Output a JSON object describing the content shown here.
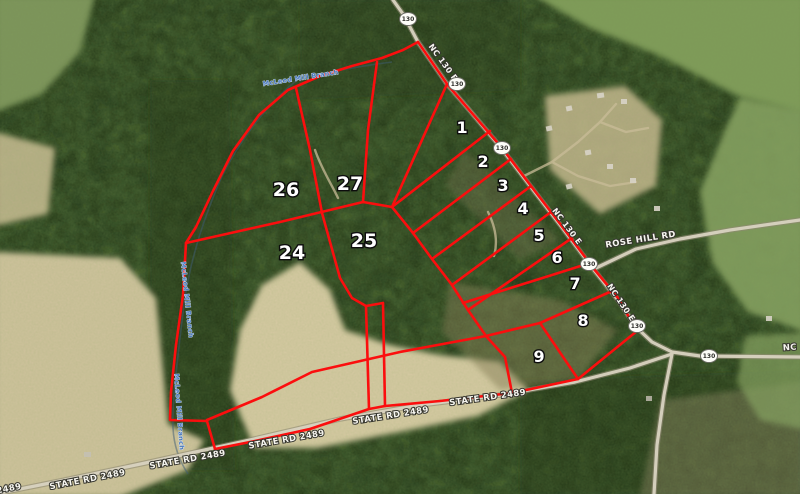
{
  "map": {
    "type": "aerial-parcel-map",
    "colors": {
      "parcel_line": "#fb0e0e",
      "lot_label_fill": "#ffffff",
      "lot_label_outline": "#0d0d0d",
      "road_label_fill": "#f7f6f0",
      "creek_label": "#4a79bd",
      "shield_fill": "#fdfdf8",
      "forest_base": "#2c4220",
      "field_tan": "#d2c59f",
      "field_green": "#7e9a58"
    },
    "lot_labels": [
      {
        "num": "1",
        "x": 462,
        "y": 133,
        "size": 16
      },
      {
        "num": "2",
        "x": 483,
        "y": 167,
        "size": 16
      },
      {
        "num": "3",
        "x": 503,
        "y": 191,
        "size": 16
      },
      {
        "num": "4",
        "x": 523,
        "y": 214,
        "size": 16
      },
      {
        "num": "5",
        "x": 539,
        "y": 241,
        "size": 16
      },
      {
        "num": "6",
        "x": 557,
        "y": 263,
        "size": 16
      },
      {
        "num": "7",
        "x": 575,
        "y": 289,
        "size": 16
      },
      {
        "num": "8",
        "x": 583,
        "y": 326,
        "size": 16
      },
      {
        "num": "9",
        "x": 539,
        "y": 362,
        "size": 16
      },
      {
        "num": "24",
        "x": 292,
        "y": 259,
        "size": 19
      },
      {
        "num": "25",
        "x": 364,
        "y": 247,
        "size": 19
      },
      {
        "num": "26",
        "x": 286,
        "y": 196,
        "size": 19
      },
      {
        "num": "27",
        "x": 350,
        "y": 190,
        "size": 19
      }
    ],
    "road_labels": [
      {
        "text": "NC 130 E",
        "x": 441,
        "y": 64,
        "rotate": 54,
        "size": 8
      },
      {
        "text": "NC 130 E",
        "x": 565,
        "y": 228,
        "rotate": 53,
        "size": 8
      },
      {
        "text": "NC 130 E",
        "x": 619,
        "y": 304,
        "rotate": 56,
        "size": 8
      },
      {
        "text": "ROSE HILL RD",
        "x": 641,
        "y": 242,
        "rotate": -9,
        "size": 8.5
      },
      {
        "text": "NC",
        "x": 790,
        "y": 350,
        "rotate": -4,
        "size": 8.5
      },
      {
        "text": "STATE RD 2489",
        "x": -16,
        "y": 496,
        "rotate": -11,
        "size": 8.5
      },
      {
        "text": "STATE RD 2489",
        "x": 88,
        "y": 482,
        "rotate": -11,
        "size": 8.5
      },
      {
        "text": "STATE RD 2489",
        "x": 188,
        "y": 462,
        "rotate": -10,
        "size": 8.5
      },
      {
        "text": "STATE RD 2489",
        "x": 287,
        "y": 442,
        "rotate": -10,
        "size": 8.5
      },
      {
        "text": "STATE RD 2489",
        "x": 391,
        "y": 418,
        "rotate": -9,
        "size": 8.5
      },
      {
        "text": "STATE RD 2489",
        "x": 488,
        "y": 400,
        "rotate": -8,
        "size": 8.5
      }
    ],
    "creek_labels": [
      {
        "text": "McLeod Mill Branch",
        "x": 301,
        "y": 80,
        "rotate": -9,
        "size": 6.5
      },
      {
        "text": "McLeod Mill Branch",
        "x": 185,
        "y": 300,
        "rotate": 84,
        "size": 6.5
      },
      {
        "text": "McLeod Mill Branch",
        "x": 177,
        "y": 412,
        "rotate": 86,
        "size": 6.5
      }
    ],
    "highway_shields": [
      {
        "num": "130",
        "x": 408,
        "y": 19
      },
      {
        "num": "130",
        "x": 457,
        "y": 84
      },
      {
        "num": "130",
        "x": 502,
        "y": 148
      },
      {
        "num": "130",
        "x": 589,
        "y": 264
      },
      {
        "num": "130",
        "x": 637,
        "y": 326
      },
      {
        "num": "130",
        "x": 709,
        "y": 356
      }
    ]
  }
}
